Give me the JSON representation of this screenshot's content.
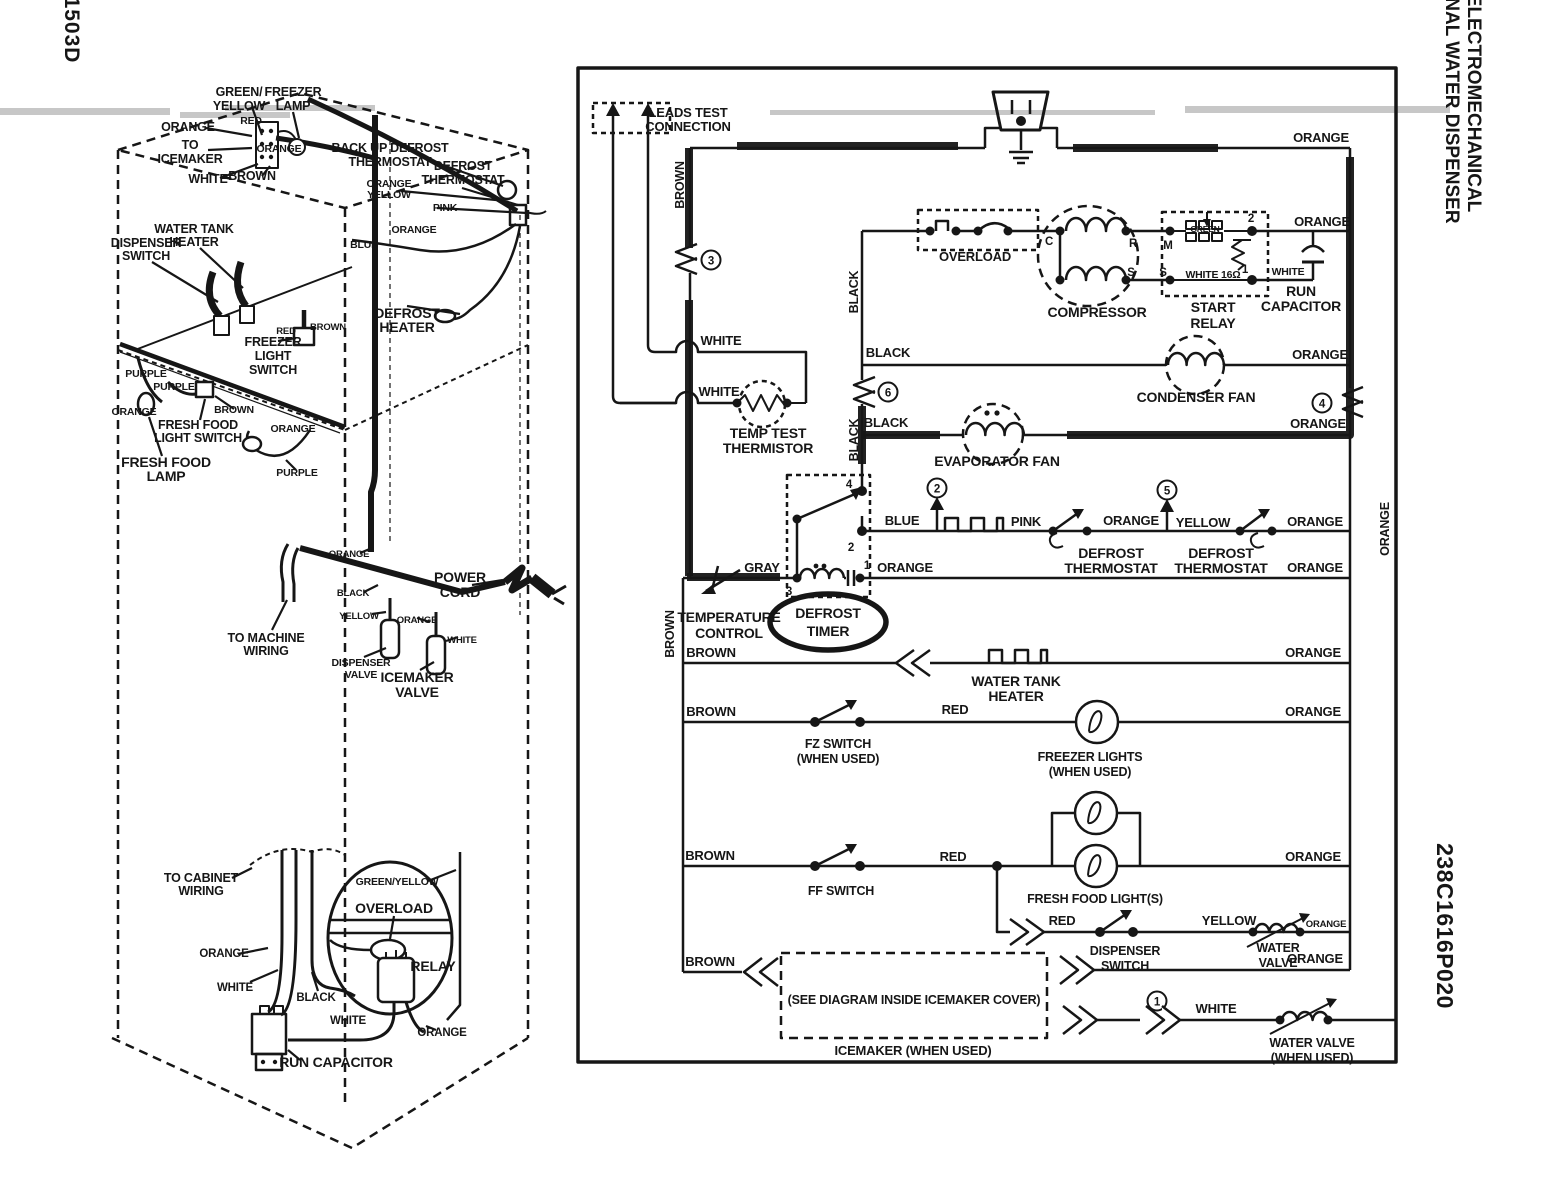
{
  "page": {
    "sheet_number": "1503D",
    "title_line1": "TMNF - 22 ELECTROMECHANICAL",
    "title_line2": "WITH INTERNAL WATER DISPENSER",
    "part_number": "238C1616P020"
  },
  "colors": {
    "brown": "#8a4a1e",
    "orange": "#f59b20",
    "red": "#e3201b"
  },
  "fridge": {
    "green_yellow": [
      "GREEN/",
      "YELLOW"
    ],
    "freezer_lamp": [
      "FREEZER",
      "LAMP"
    ],
    "orange_icemaker": "ORANGE",
    "red": "RED",
    "to_icemaker": [
      "TO",
      "ICEMAKER"
    ],
    "orange_lamp": "ORANGE",
    "white": "WHITE",
    "brown": "BROWN",
    "backup_defrost_thermostat": [
      "BACK UP DEFROST",
      "THERMOSTAT"
    ],
    "defrost_thermostat": [
      "DEFROST",
      "THERMOSTAT"
    ],
    "orange_yellow": [
      "ORANGE",
      "YELLOW"
    ],
    "pink": "PINK",
    "orange_heater": "ORANGE",
    "blue": "BLUE",
    "water_tank_heater": [
      "WATER TANK",
      "HEATER"
    ],
    "dispenser_switch": [
      "DISPENSER",
      "SWITCH"
    ],
    "defrost_heater": [
      "DEFROST",
      "HEATER"
    ],
    "freezer_light_switch": [
      "FREEZER",
      "LIGHT",
      "SWITCH"
    ],
    "red_fz": "RED",
    "brown_fz": "BROWN",
    "purple_a": "PURPLE",
    "purple_b": "PURPLE",
    "orange_ff": "ORANGE",
    "brown_ff": "BROWN",
    "fresh_food_light_switch": [
      "FRESH FOOD",
      "LIGHT SWITCH"
    ],
    "orange_ff_lamp": "ORANGE",
    "fresh_food_lamp": [
      "FRESH FOOD",
      "LAMP"
    ],
    "purple_c": "PURPLE",
    "orange_trunk": "ORANGE",
    "black_trunk": "BLACK",
    "yellow_valve": "YELLOW",
    "orange_valve": "ORANGE",
    "white_valve": "WHITE",
    "to_machine_wiring": [
      "TO MACHINE",
      "WIRING"
    ],
    "dispenser_valve": [
      "DISPENSER",
      "VALVE"
    ],
    "icemaker_valve": [
      "ICEMAKER",
      "VALVE"
    ],
    "power_cord": [
      "POWER",
      "CORD"
    ]
  },
  "detail": {
    "to_cabinet_wiring": [
      "TO CABINET",
      "WIRING"
    ],
    "green_yellow": "GREEN/YELLOW",
    "overload": "OVERLOAD",
    "orange": "ORANGE",
    "white": "WHITE",
    "black": "BLACK",
    "relay": "RELAY",
    "white2": "WHITE",
    "orange2": "ORANGE",
    "run_capacitor": "RUN CAPACITOR"
  },
  "sch": {
    "leads_test": [
      "LEADS TEST",
      "CONNECTION"
    ],
    "brown_vert": "BROWN",
    "tp": [
      "1",
      "2",
      "3",
      "4",
      "5",
      "6"
    ],
    "orange_top": "ORANGE",
    "overload": "OVERLOAD",
    "compressor": "COMPRESSOR",
    "c": "C",
    "r": "R",
    "s": "S",
    "m": "M",
    "s2": "S",
    "t2": "2",
    "t1": "1",
    "green": "GREEN",
    "white_ohm": "WHITE 16Ω",
    "start_relay": [
      "START",
      "RELAY"
    ],
    "white_cap": "WHITE",
    "run_capacitor": [
      "RUN",
      "CAPACITOR"
    ],
    "orange_relay_row": "ORANGE",
    "black_cond": "BLACK",
    "condenser_fan": "CONDENSER FAN",
    "orange_cond": "ORANGE",
    "white1": "WHITE",
    "white2": "WHITE",
    "temp_test_thermistor": [
      "TEMP TEST",
      "THERMISTOR"
    ],
    "black_rot1": "BLACK",
    "black_evap": "BLACK",
    "black_rot2": "BLACK",
    "evaporator_fan": "EVAPORATOR FAN",
    "orange_evap": "ORANGE",
    "blue": "BLUE",
    "pink": "PINK",
    "defrost_thermostat1": [
      "DEFROST",
      "THERMOSTAT"
    ],
    "orange_dt": "ORANGE",
    "yellow": "YELLOW",
    "defrost_thermostat2": [
      "DEFROST",
      "THERMOSTAT"
    ],
    "orange_dt2": "ORANGE",
    "gray": "GRAY",
    "temperature_control": [
      "TEMPERATURE",
      "CONTROL"
    ],
    "defrost_timer": [
      "DEFROST",
      "TIMER"
    ],
    "n4": "4",
    "n2": "2",
    "n3": "3",
    "n1": "1",
    "orange_timer": "ORANGE",
    "orange_timer2": "ORANGE",
    "brown_rot": "BROWN",
    "brown_wt": "BROWN",
    "water_tank_heater": [
      "WATER TANK",
      "HEATER"
    ],
    "orange_wt": "ORANGE",
    "brown_fz": "BROWN",
    "fz_switch": [
      "FZ SWITCH",
      "(WHEN USED)"
    ],
    "red_fz": "RED",
    "freezer_lights": [
      "FREEZER LIGHTS",
      "(WHEN USED)"
    ],
    "orange_fz": "ORANGE",
    "brown_ff": "BROWN",
    "ff_switch": "FF SWITCH",
    "red_ff": "RED",
    "fresh_food_lights": "FRESH FOOD LIGHT(S)",
    "orange_ff": "ORANGE",
    "red_disp": "RED",
    "dispenser_switch": [
      "DISPENSER",
      "SWITCH"
    ],
    "yellow_disp": "YELLOW",
    "water_valve": [
      "WATER",
      "VALVE"
    ],
    "orange_wv": "ORANGE",
    "orange_disp": "ORANGE",
    "brown_im": "BROWN",
    "see_diagram": "(SEE DIAGRAM INSIDE ICEMAKER COVER)",
    "icemaker": "ICEMAKER (WHEN USED)",
    "white_im": "WHITE",
    "water_valve2": [
      "WATER VALVE",
      "(WHEN USED)"
    ],
    "orange_bus_rot": "ORANGE"
  }
}
